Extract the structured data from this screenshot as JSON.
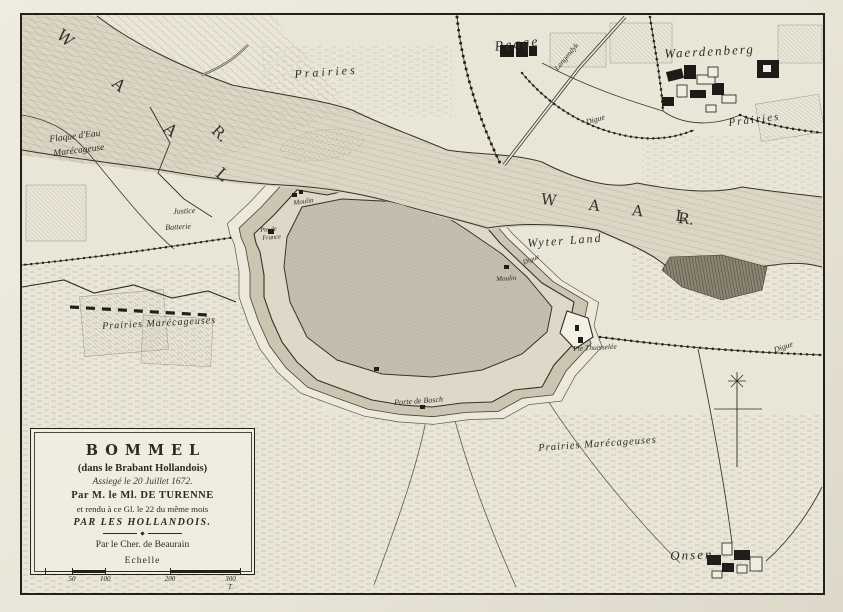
{
  "map": {
    "title_place": "Bommel (Zaltbommel), Brabant Hollandois",
    "colors": {
      "paper": "#eae6d8",
      "ink": "#2c2a24",
      "river_fill": "#dcd6c5",
      "town_fill": "#c7c2b1",
      "cartouche_bg": "#f0ecdf"
    }
  },
  "labels": {
    "river_nw": "W A A L",
    "river_nw_r": "R.",
    "river_mid": "W A A L",
    "river_mid_r": "R.",
    "prairies_top": "Prairies",
    "peage": "Peage",
    "dyke_road": "Langendyk",
    "digue_north": "Digue",
    "waerdenberg": "Waerdenberg",
    "prairies_ne": "Prairies",
    "flaque_1": "Flaque d'Eau",
    "flaque_2": "Marécageuse",
    "justice": "Justice",
    "batterie": "Batterie",
    "pte_france_1": "Pte de",
    "pte_france_2": "France",
    "moulin_w": "Moulin",
    "wyter_land": "Wyter Land",
    "digue_ne": "Digue",
    "moulin_e": "Moulin",
    "pte_thuisselee": "Pte Thuisselée",
    "porte_bosch": "Porte de Bosch",
    "prairies_sw": "Prairies Marécageuses",
    "prairies_se": "Prairies Marécageuses",
    "digue_e": "Digue",
    "onsen": "Onsen"
  },
  "cartouche": {
    "title": "BOMMEL",
    "subtitle": "(dans le Brabant Hollandois)",
    "siege_line": "Assiegé le 20 Juillet 1672.",
    "by_line": "Par M. le Ml. DE TURENNE",
    "rendered_line": "et rendu à ce Gl. le 22 du même mois",
    "hollandois_line": "PAR LES HOLLANDOIS.",
    "author": "Par le Cher. de Beaurain",
    "scale_label": "Echelle",
    "scale_ticks": [
      "50",
      "100",
      "200",
      "300 T."
    ]
  }
}
